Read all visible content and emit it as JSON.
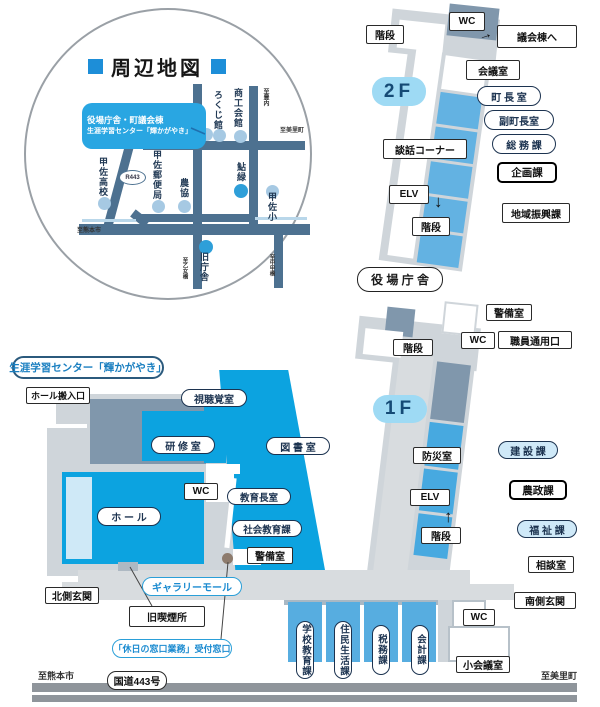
{
  "common": {
    "stairs": "階段",
    "wc": "WC",
    "elevator": "ELV",
    "security_room": "警備室",
    "down_arrow": "↓",
    "up_arrow": "↑",
    "pointer_arrow": "→"
  },
  "area_map": {
    "title": "周辺地図",
    "info_line1": "役場庁舎・町議会棟",
    "info_line2": "生涯学習センター「輝かがやき」",
    "route_badge": "R443",
    "spots": {
      "rokuji_kan": "ろくじ館",
      "shoko_kaikan": "商工会館",
      "kosa_koko": "甲佐高校",
      "kosa_yubinkyoku": "甲佐郵便局",
      "nokyo": "農協",
      "ayumidori": "鮎緑",
      "kosa_sho": "甲佐小",
      "kyu_chosha": "旧庁舎"
    },
    "directions": {
      "to_toyouchi": "至豊内",
      "to_misato": "至美里町",
      "to_kumamoto": "至熊本市",
      "to_otomebashi": "至乙女橋",
      "to_chukobashi": "至中甲橋"
    }
  },
  "floor2": {
    "badge": "2F",
    "building_label": "役 場 庁 舎",
    "to_gikaito": "議会棟へ",
    "kaigishitsu": "会議室",
    "chocho_shitsu": "町 長 室",
    "fukuchocho_shitsu": "副町長室",
    "somu_ka": "総 務 課",
    "kikaku_ka": "企画課",
    "chiiki_shinko_ka": "地域振興課",
    "danwa_corner": "談話コーナー"
  },
  "floor1": {
    "badge": "1F",
    "shokuin_tsuyoguchi": "職員通用口",
    "bosai_shitsu": "防災室",
    "kensetsu_ka": "建 設 課",
    "nosei_ka": "農政課",
    "fukushi_ka": "福 祉 課",
    "sodan_shitsu": "相談室",
    "minamigawa_genkan": "南側玄関",
    "shokaigishitsu": "小会議室",
    "gakko_kyoiku_ka": "学校教育課",
    "jumin_seikatsu_ka": "住民生活課",
    "zeimu_ka": "税務課",
    "kaikei_ka": "会計課"
  },
  "center": {
    "title": "生涯学習センター「輝かがやき」",
    "hall_hannyuguchi": "ホール搬入口",
    "shichokaku_shitsu": "視聴覚室",
    "kenshu_shitsu": "研 修 室",
    "tosho_shitsu": "図 書 室",
    "hall": "ホ ー ル",
    "kyoikucho_shitsu": "教育長室",
    "shakai_kyoiku_ka": "社会教育課",
    "gallery_mall": "ギャラリーモール",
    "kitagawa_genkan": "北側玄関",
    "kyu_kitsuensho": "旧喫煙所",
    "kyujitsu_madoguchi": "「休日の窓口業務」受付窓口"
  },
  "road": {
    "name": "国道443号",
    "left": "至熊本市",
    "right": "至美里町"
  },
  "colors": {
    "accent_blue": "#0ca3e0",
    "mid_blue": "#63b2e2",
    "steel": "#8097ac",
    "road": "#4d7190",
    "badge_bg": "#9edaf4",
    "label_navy": "#1c3350"
  }
}
